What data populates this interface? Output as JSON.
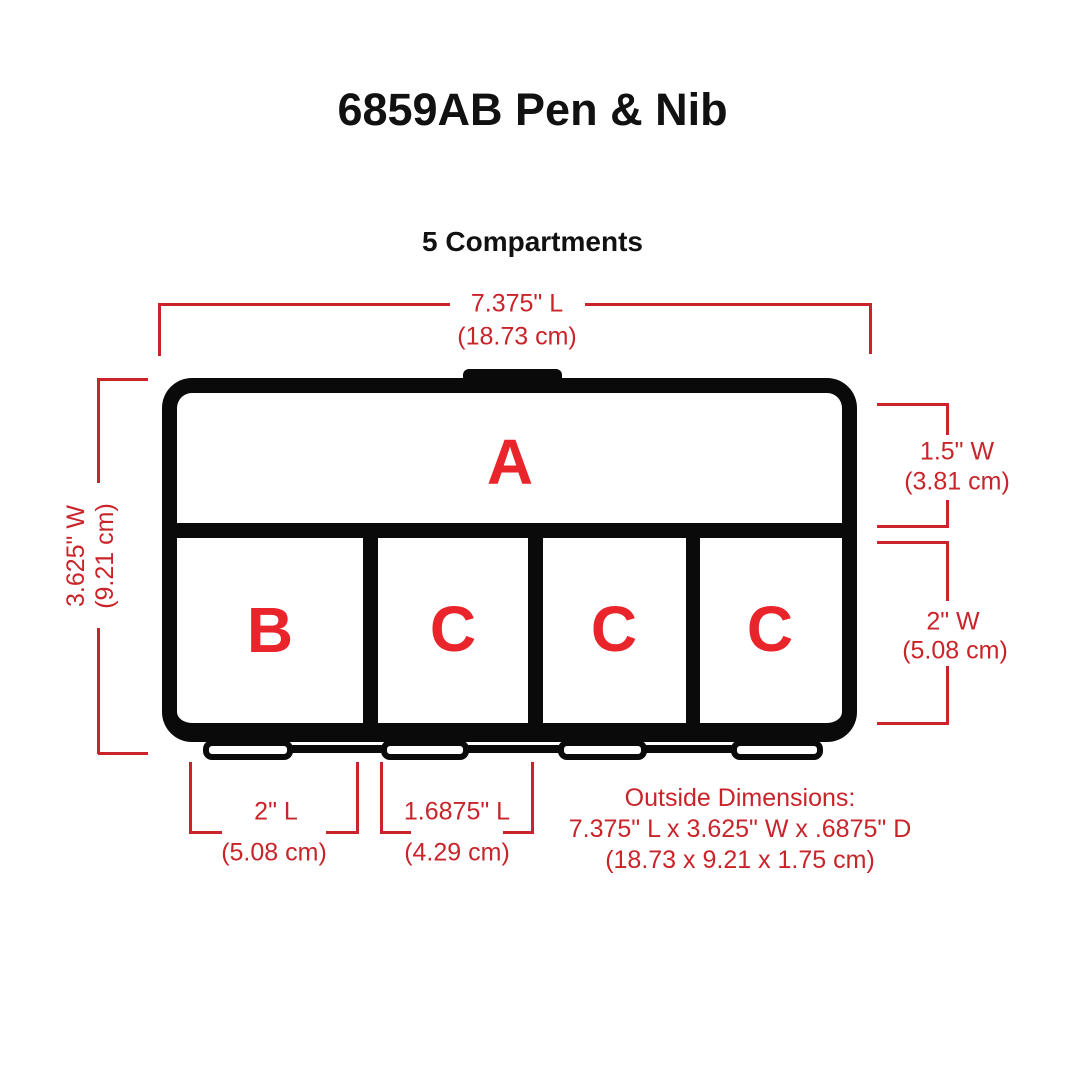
{
  "title": "6859AB Pen & Nib",
  "subtitle": "5 Compartments",
  "compartments": {
    "a": "A",
    "b": "B",
    "c1": "C",
    "c2": "C",
    "c3": "C"
  },
  "dims": {
    "length": {
      "label": "7.375\" L",
      "metric": "(18.73 cm)"
    },
    "width": {
      "label": "3.625\" W",
      "metric": "(9.21 cm)"
    },
    "a_width": {
      "label": "1.5\" W",
      "metric": "(3.81 cm)"
    },
    "bc_width": {
      "label": "2\" W",
      "metric": "(5.08 cm)"
    },
    "b_length": {
      "label": "2\" L",
      "metric": "(5.08 cm)"
    },
    "c_length": {
      "label": "1.6875\" L",
      "metric": "(4.29 cm)"
    },
    "outside": {
      "heading": "Outside Dimensions:",
      "inches": "7.375\" L x 3.625\" W x .6875\" D",
      "metric": "(18.73 x 9.21 x 1.75 cm)"
    }
  },
  "colors": {
    "dimension_red": "#c9242a",
    "letter_red": "#e9242b",
    "line_black": "#0a0a0a"
  }
}
